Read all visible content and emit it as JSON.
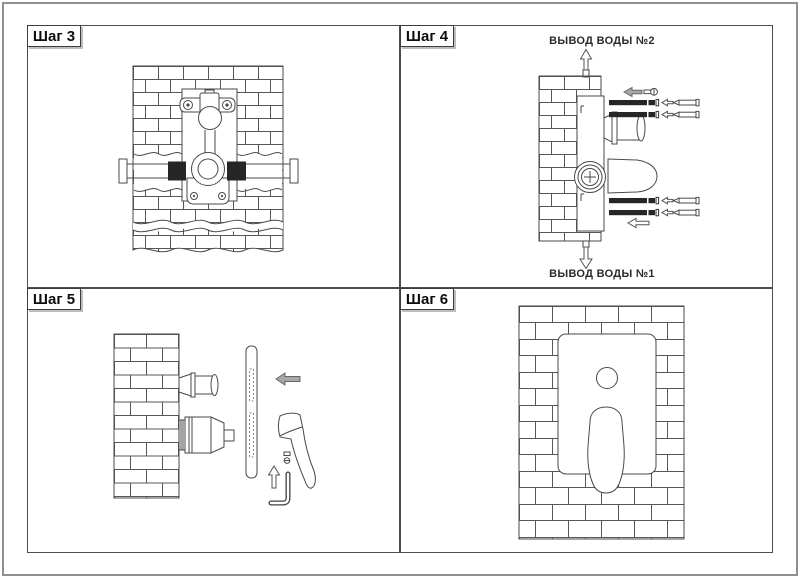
{
  "page": {
    "background": "#ffffff",
    "outer_border_color": "#8f8f8f",
    "panel_border_color": "#4d4d4d",
    "line_color": "#4a4a4a"
  },
  "panels": [
    {
      "id": "step-3",
      "label": "Шаг 3",
      "drawing": "mixer-body-mounted-in-brick-wall-front-view",
      "icons": [
        "brick-wall",
        "mixer-valve",
        "supply-pipe",
        "mounting-bracket"
      ]
    },
    {
      "id": "step-4",
      "label": "Шаг 4",
      "drawing": "mixer-body-wall-side-view-with-anchors",
      "annotations": {
        "top": "ВЫВОД ВОДЫ №2",
        "bottom": "ВЫВОД ВОДЫ №1"
      },
      "icons": [
        "up-arrow",
        "down-arrow",
        "left-arrow",
        "bolt",
        "wall-anchor",
        "screw",
        "spout-connector",
        "protective-cone"
      ]
    },
    {
      "id": "step-5",
      "label": "Шаг 5",
      "drawing": "faceplate-handle-and-hex-key-side-view",
      "icons": [
        "brick-wall",
        "faceplate",
        "left-arrow",
        "up-arrow",
        "handle-lever",
        "set-screw",
        "allen-key"
      ]
    },
    {
      "id": "step-6",
      "label": "Шаг 6",
      "drawing": "finished-installation-front-view",
      "icons": [
        "brick-wall",
        "faceplate",
        "diverter-knob",
        "handle-lever"
      ]
    }
  ]
}
